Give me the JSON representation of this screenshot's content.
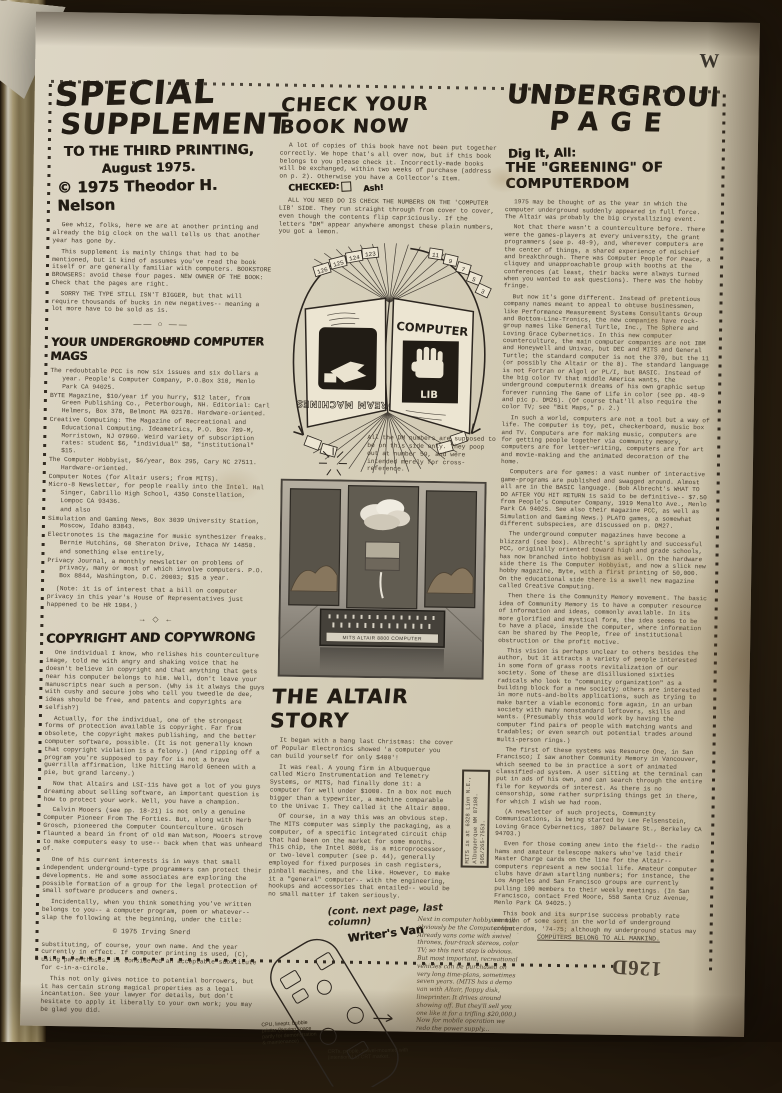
{
  "page": {
    "corner_letter": "W",
    "page_number": "126D"
  },
  "left_column": {
    "title1": "SPECIAL",
    "title2": "SUPPLEMENT",
    "title3": "TO THE THIRD PRINTING,",
    "title4": "August 1975.",
    "title5": "© 1975 Theodor H. Nelson",
    "hand_note": "well",
    "intro": [
      "Gee whiz, folks, here we are at another printing and already the big clock on the wall tells us that another year has gone by.",
      "This supplement is mainly things that had to be mentioned, but it kind of assumes you've read the book itself or are generally familiar with computers. BOOKSTORE BROWSERS: avoid these four pages. NEW OWNER OF THE BOOK: Check that the pages are right.",
      "SORRY THE TYPE STILL ISN'T BIGGER, but that will require thousands of bucks in new negatives-- meaning a lot more have to be sold as is."
    ],
    "divider1": "—— ○ ——",
    "mags_heading": "YOUR UNDERGROUND COMPUTER MAGS",
    "mags": [
      "The redoubtable PCC is now six issues and six dollars a year.  People's Computer Company, P.O.Box 310, Menlo Park CA 94025.",
      "BYTE Magazine, $10/year if you hurry, $12 later, from Green Publishing Co., Peterborough, NH. Editorial: Carl Helmers, Box 378, Belmont MA 02178.  Hardware-oriented.",
      "Creative Computing: The Magazine of Recreational and Educational Computing.  Ideametrics, P.O. Box 789-M, Morristown, NJ 07960.  Weird variety of subscription rates: student $6, \"individual\" $8, \"institutional\" $15.",
      "The Computer Hobbyist, $6/year, Box 295, Cary NC 27511.  Hardware-oriented.",
      "Computer Notes (for Altair users; from MITS).",
      "Micro-8 Newsletter, for people really into the Intel.  Hal Singer, Cabrillo High School, 4350 Constellation, Lompoc CA 93436.",
      "and also",
      "Simulation and Gaming News, Box 3039 University Station, Moscow, Idaho 83843.",
      "Electronotes is the magazine for music synthesizer freaks.  Bernie Hutchins, 60 Sheraton Drive, Ithaca NY 14850.",
      "and something else entirely,",
      "Privacy Journal, a monthly newsletter on problems of privacy, many or most of which involve computers.  P.O. Box 8844, Washington, D.C. 20003; $15 a year."
    ],
    "mags_note": "(Note: it is of interest that a bill on computer privacy in this year's House of Representatives just happened to be HR 1984.)",
    "divider2": "→ ◇ ←",
    "copyright_heading": "COPYRIGHT AND COPYWRONG",
    "copyright_paras": [
      "One individual I know, who relishes his counterculture image, told me with angry and shaking voice that he doesn't believe in copyright and that anything that gets near his computer belongs to him.  Well, don't leave your manuscripts near such a person.  (Why is it always the guys with cushy and secure jobs who tell you tweedle de dee, ideas should be free, and patents and copyrights are selfish?)",
      "Actually, for the individual, one of the strongest forms of protection available is copyright.  Far from obsolete, the copyright makes publishing, and the better computer software, possible.  (It is not generally known that copyright violation is a felony.) (And ripping off a program you're supposed to pay for is not a brave guerrilla affirmation, like hitting Harold Geneen with a pie, but grand larceny.)",
      "Now that Altairs and LSI-11s have got a lot of you guys dreaming about selling software, an important question is how to protect your work.  Well, you have a champion.",
      "Calvin Mooers (see pp. 18-21) is not only a genuine Computer Pioneer From The Forties. But, along with Herb Grosch, pioneered the Computer Counterculture.  Grosch flaunted a beard in front of old man Watson, Mooers strove to make computers easy to use-- back when that was unheard of.",
      "One of his current interests is in ways that small independent underground-type programmers can protect their developments.  He and some associates are exploring the possible formation of a group for the legal protection of small software producers and owners.",
      "Incidentally, when you think something you've written belongs to you-- a computer program, poem or whatever-- slap the following at the beginning, under the title:"
    ],
    "snerd": "©  1975 Irving Snerd",
    "closing": [
      "substituting, of course, your own name.  And the year currently in effect.  If computer printing is used, (C), using parentheses, is considered an acceptable substitute for c-in-a-circle.",
      "This not only gives notice to potential borrowers, but it has certain strong magical properties as a legal incantation.  See your lawyer for details, but don't hesitate to apply it liberally to your own work; you may be glad you did."
    ]
  },
  "middle_column": {
    "check_heading": "CHECK YOUR BOOK NOW",
    "check_para1": "A lot of copies of this book have not been put together correctly. We hope that's all over now, but if this book belongs to you please check it.  Incorrectly-made books will be exchanged, within two weeks of purchase (address on p. 2).  Otherwise you have a Collector's Item.",
    "checked_label": "CHECKED:",
    "checked_note": "Ash!",
    "check_para2": "ALL YOU NEED DO IS CHECK THE NUMBERS ON THE 'COMPUTER LIB' SIDE. They run straight through from cover to cover, even though the contents flip capriciously.  If the letters \"DM\" appear anywhere amongst these plain numbers, you got a lemon.",
    "diagram": {
      "left_cover_title": "DREAM MACHINES",
      "right_cover_word": "COMPUTER",
      "right_cover_sub": "LIB",
      "tabs_left": [
        "126",
        "125",
        "124",
        "123"
      ],
      "tabs_right": [
        "11",
        "9",
        "7",
        "5",
        "3"
      ],
      "caption": "All the DM numbers are supposed to be on this side only.  They poop out at number 59, and were intended merely for cross-reference."
    },
    "ad_label": "MITS ALTAIR 8800 COMPUTER",
    "altair_heading": "THE ALTAIR STORY",
    "altair_paras": [
      "It began with a bang last Christmas: the cover of Popular Electronics showed 'a computer you can build yourself for only $400'!",
      "It was real.  A young firm in Albuquerque called Micro Instrumentation and Telemetry Systems, or MITS, had finally done it: a computer for well under $1000.  In a box not much bigger than a typewriter, a machine comparable to the Univac I.  They called it the Altair 8800.",
      "Of course, in a way this was an obvious step.  The MITS computer was simply the packaging, as a computer, of a specific integrated circuit chip that had been on the market for some months.  This chip, the Intel 8080, is a microprocessor, or two-level computer (see p. 44), generally employed for fixed purposes in cash registers, pinball machines, and the like. However, to make it a \"general\" computer-- with the engineering, hookups and accessories that entailed-- would be no small matter if taken seriously."
    ],
    "cont_note": "(cont. next page, last column)",
    "mits_box": "MITS is at 6328 Linn N.E., Albuquerque NM 87108.  505/265-7553.",
    "van_title": "Writer's Van",
    "van_note_left": "CPU, lineptr, bubble printer (leaving space partly for demonstration & maintenance)",
    "van_note_bottom": "CRTs, people, swivel-mounted with (intentions) to CRT market.",
    "van_para": "Next in computer hobbyism will obviously be the Computer Van.  Already vans come with swivel thrones, four-track stereos, color TV; so this next step is obvious.  But most important, recreational vehicles can be purchased on very long time-plans, sometimes seven years. (MITS has a demo van with Altair, floppy disk, lineprinter. It drives around showing off. But they'll sell you one like it for a trifling $20,000.)  Now for mobile operation we redo the power supply..."
  },
  "right_column": {
    "title1": "UNDERGROUND",
    "title2": "PAGE",
    "sub1": "Dig It, All:",
    "sub2": "THE \"GREENING\" OF COMPUTERDOM",
    "paragraphs": [
      "1975 may be thought of as the year in which the computer underground suddenly appeared in full force.  The Altair was probably the big crystallizing event.",
      "Not that there wasn't a counterculture before.  There were the games-players at every university, the grant programmers (see p. 48-9), and, wherever computers are the center of things, a shared experience of mischief and breakthrough. There was Computer People for Peace, a cliquey and unapproachable group with booths at the conferences (at least, their backs were always turned when you wanted to ask questions).  There was the hobby fringe.",
      "But now it's gone different.  Instead of pretentious company names meant to appeal to obtuse businessmen, like Performance Measurement Systems Consultants Group and Bottom-Line-Tronics, the new companies have rock-group names like General Turtle, Inc., The Sphere and Loving Grace Cybernetics.  In this new computer counterculture, the main computer companies are not IBM and Honeywell and Univac, but DEC and MITS and General Turtle; the standard computer is not the 370, but the 11 (or possibly the Altair or the 8). The standard language is not Fortran or Algol or PL/I, but BASIC.  Instead of the big color TV that middle America wants, the underground computernik dreams of his own graphic setup forever running The Game of Life in color (see pp. 48-9 and pic p. DM26).  (Of course that'll also require the color TV; see \"Bit Maps,\" p. 2.)",
      "In such a world, computers are not a tool but a way of life.  The computer is toy, pet, checkerboard, music box and TV.  Computers are for making music, computers are for getting people together via community memory, computers are for letter-writing, computers are for art and movie-making and the animated decoration of the home.",
      "Computers are for games: a vast number of interactive game-programs are published and swagged around.  Almost all are in the BASIC language.  (Bob Albrecht's WHAT TO DO AFTER YOU HIT RETURN is said to be definitive-- $7.50 from People's Computer Company, 1919 Menalto Ave., Menlo Park CA 94025.  See also their magazine PCC, as well as Simulation and Gaming News.) PLATO games, a somewhat different subspecies, are discussed on p. DM27.",
      "The underground computer magazines have become a blizzard (see box).  Albrecht's sprightly and successful PCC, originally oriented toward high and grade schools, has now branched into hobbyism as well.  On the hardware side there is The Computer Hobbyist, and now a slick new hobby magazine, Byte, with a first printing of 50,000. On the educational side there is a swell new magazine called Creative Computing.",
      "Then there is the Community Memory movement. The basic idea of Community Memory is to have a computer resource of information and ideas, commonly available.  In its more glorified and mystical form, the idea seems to be to have a place, inside the computer, where information can be shared by The People, free of institutional obstruction or the profit motive.",
      "This vision is perhaps unclear to others besides the author, but it attracts a variety of people interested in some form of grass roots revitalization of our society.  Some of these are disillusioned sixties radicals who look to \"community organization\" as a building block for a new society; others are interested in more nuts-and-bolts applications, such as trying to make barter a viable economic form again, in an urban society with many nonstandard leftovers, skills and wants.  (Presumably this would work by having the computer find pairs of people with matching wants and tradables; or even search out potential trades around multi-person rings.)",
      "The first of these systems was Resource One, in San Francisco; I saw another Community Memory in Vancouver, which seemed to be in practice a sort of animated classified-ad system.  A user sitting at the terminal can put in ads of his own, and can search through the entire file for keywords of interest.  As there is no censorship, some rather surprising things get in there, for which I wish we    had room.",
      "(A newsletter of such projects, Community Communications, is being started by Lee Felsenstein, Loving Grace Cybernetics, 1807 Delaware St., Berkeley CA 94703.)",
      "Even for those coming anew into the field-- the radio hams and amateur telescope makers who've laid their Master Charge cards on the line for the Altair-- computers represent a new social life. Amateur computer clubs have drawn startling numbers; for instance, the Los Angeles and San Francisco groups are currently pulling 100 members to their weekly meetings.  (In San Francisco, contact Fred Moore, 558 Santa Cruz Avenue, Menlo Park CA 94025.)",
      "This book and its surprise success probably rate mention of some sort in the world of underground computerdom, '74-75; although my underground status may be in jeopardy.  I had intended to bypass the computer establishment, and certainly not expected to become assimilated therein; so the dozens of university class adoptions have come as a considerable shock, as have the acceptance and legitimation I had long since given up on.  My heartfelt thanks for this response, and I'll try to live up to it.  (How is discussed on p. 2, last column.)",
      "But folks, this all is the merest beginning. As it says on diametrically the other side, p. 1,"
    ],
    "slogan": "COMPUTERS BELONG TO ALL MANKIND."
  }
}
